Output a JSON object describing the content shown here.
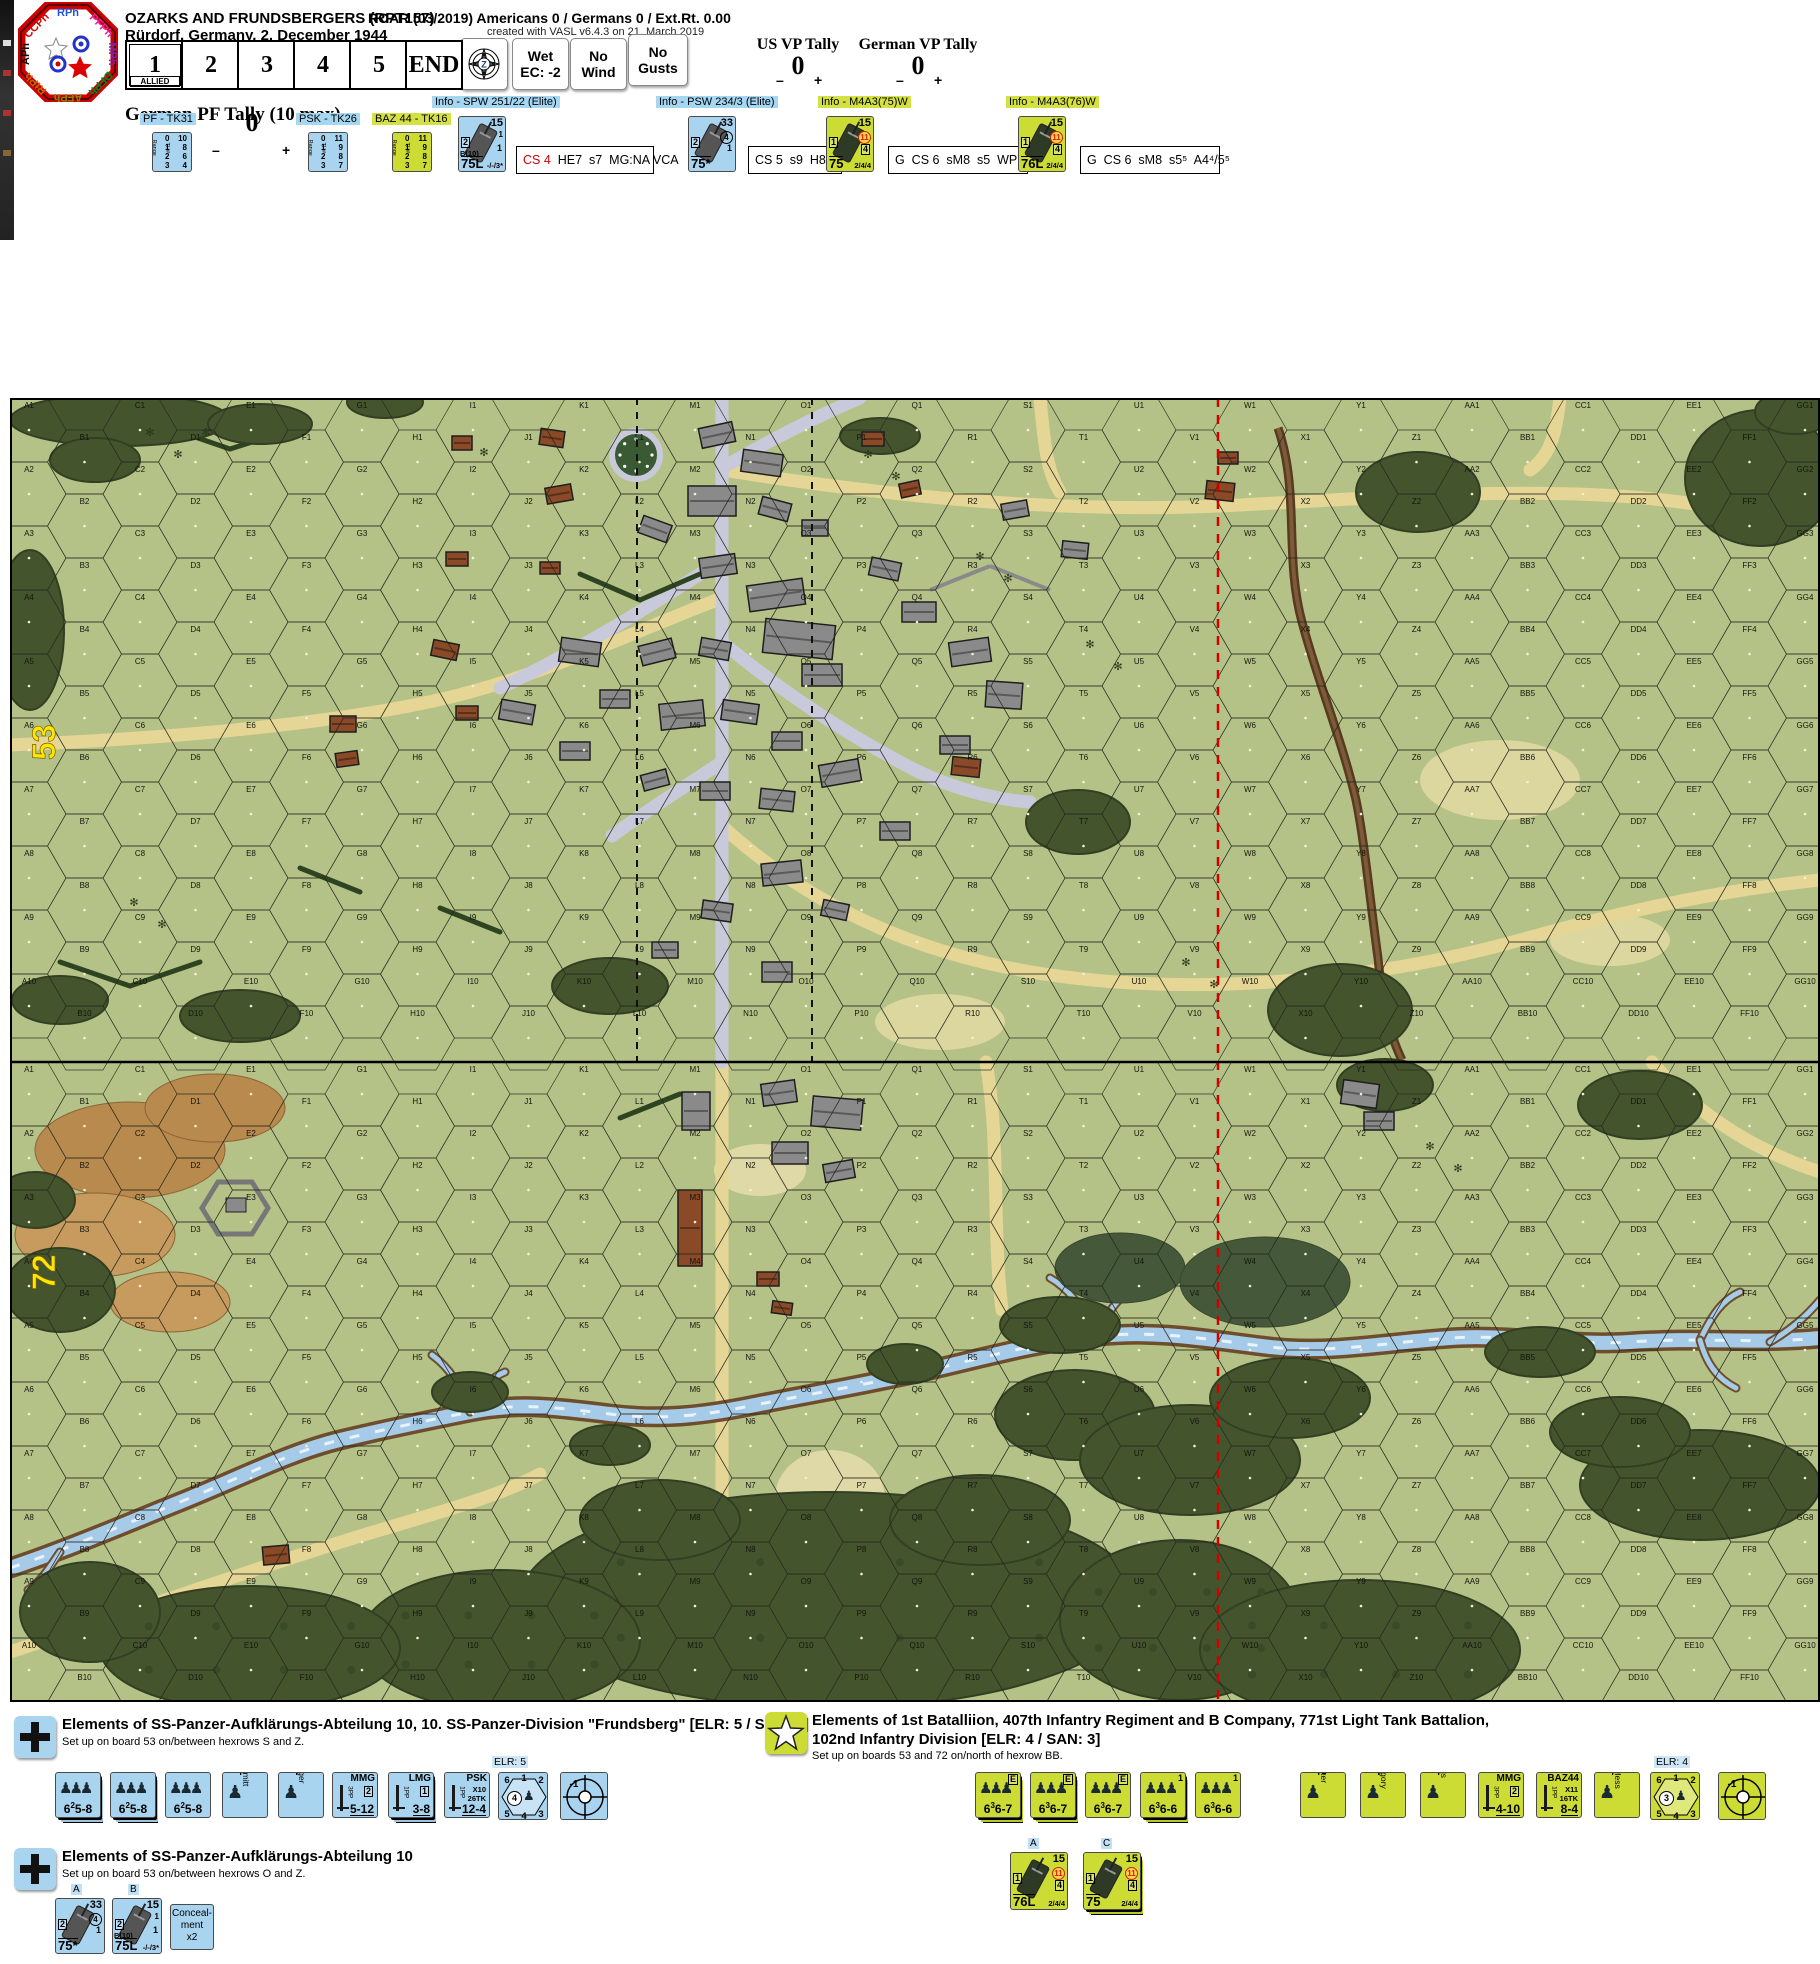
{
  "window": {
    "phase_wheel": {
      "phases": [
        {
          "label": "RPh",
          "color": "#2255dd"
        },
        {
          "label": "PFPh",
          "color": "#ee22aa"
        },
        {
          "label": "MPh",
          "color": "#7722bb"
        },
        {
          "label": "DFPh",
          "color": "#008822"
        },
        {
          "label": "AFPh",
          "color": "#888800"
        },
        {
          "label": "RtPh",
          "color": "#cc6600"
        },
        {
          "label": "APh",
          "color": "#111111"
        },
        {
          "label": "CCPh",
          "color": "#dd0000"
        }
      ]
    },
    "title": "OZARKS AND FRUNDSBERGERS (RPT157)",
    "subtitle": "Rürdorf, Germany, 2. December 1944",
    "roar": "ROAR (03/2019) Americans 0 / Germans 0 / Ext.Rt. 0.00",
    "created": "created with VASL v6.4.3 on 21. March 2019",
    "turn_track": {
      "cells": [
        "1",
        "2",
        "3",
        "4",
        "5",
        "END"
      ],
      "active_index": 0,
      "active_sub": "ALLIED"
    },
    "weather": [
      [
        "Wet",
        "EC: -2"
      ],
      [
        "No",
        "Wind"
      ],
      [
        "No",
        "Gusts"
      ]
    ],
    "us_vp": {
      "label": "US VP Tally",
      "value": "0",
      "minus": "–",
      "plus": "+"
    },
    "german_vp": {
      "label": "German VP Tally",
      "value": "0",
      "minus": "–",
      "plus": "+"
    },
    "pf_tally": {
      "label": "German PF Tally (10 max)",
      "value": "0",
      "minus": "–",
      "plus": "+"
    }
  },
  "ordnance": [
    {
      "label": "PF - TK31",
      "style": "blue",
      "x": 140,
      "cx": 152,
      "col1": "Range",
      "col2": "TH#",
      "rows": [
        [
          "0",
          "10"
        ],
        [
          "1",
          "8"
        ],
        [
          "2",
          "6"
        ],
        [
          "3",
          "4"
        ]
      ]
    },
    {
      "label": "PSK - TK26",
      "style": "blue",
      "x": 296,
      "cx": 308,
      "col1": "Range",
      "col2": "TH#",
      "rows": [
        [
          "0",
          "11"
        ],
        [
          "1",
          "9"
        ],
        [
          "2",
          "8"
        ],
        [
          "3",
          "7"
        ]
      ]
    },
    {
      "label": "BAZ 44 - TK16",
      "style": "grn",
      "x": 372,
      "cx": 392,
      "col1": "Range",
      "col2": "TH#",
      "rows": [
        [
          "0",
          "11"
        ],
        [
          "1",
          "9"
        ],
        [
          "2",
          "8"
        ],
        [
          "3",
          "7"
        ]
      ]
    }
  ],
  "vehicles": [
    {
      "label": "Info - SPW 251/22 (Elite)",
      "style": "blue",
      "lx": 432,
      "cx": 458,
      "bx": 516,
      "bw": 124,
      "tr": "15",
      "m1": "1",
      "m2": "1",
      "left": "2",
      "b10": "B(10)",
      "gun": "75L",
      "extra": "-/-/3*",
      "info": [
        [
          "CS 4",
          "red"
        ],
        [
          "  HE7  s7  MG:NA VCA",
          ""
        ]
      ]
    },
    {
      "label": "Info - PSW 234/3 (Elite)",
      "style": "blue",
      "lx": 656,
      "cx": 688,
      "bx": 748,
      "bw": 80,
      "tr": "33",
      "m1": "(4)",
      "m2": "1",
      "left": "2",
      "b10": "",
      "gun": "75*",
      "extra": "",
      "info": [
        [
          "CS 5  s9  H8",
          ""
        ]
      ]
    },
    {
      "label": "Info - M4A3(75)W",
      "style": "grn",
      "lx": 818,
      "cx": 826,
      "bx": 888,
      "bw": 126,
      "tr": "15",
      "m1": "(11)",
      "m2": "[4]",
      "left": "1",
      "b10": "",
      "gun": "75",
      "extra": "2/4/4",
      "info": [
        [
          "G  CS 6  sM8  s5  WP7",
          ""
        ]
      ]
    },
    {
      "label": "Info - M4A3(76)W",
      "style": "grn",
      "lx": 1006,
      "cx": 1018,
      "bx": 1080,
      "bw": 126,
      "tr": "15",
      "m1": "(11)",
      "m2": "[4]",
      "left": "1",
      "b10": "",
      "gun": "76L",
      "extra": "2/4/4",
      "info": [
        [
          "G  CS 6  sM8  s5⁵  A4⁴/5⁵",
          ""
        ]
      ]
    }
  ],
  "map": {
    "board53": "53",
    "board72": "72",
    "columns": [
      "A",
      "B",
      "C",
      "D",
      "E",
      "F",
      "G",
      "H",
      "I",
      "J",
      "K",
      "L",
      "M",
      "N",
      "O",
      "P",
      "Q",
      "R",
      "S",
      "T",
      "U",
      "V",
      "W",
      "X",
      "Y",
      "Z",
      "AA",
      "BB",
      "CC",
      "DD",
      "EE",
      "FF",
      "GG"
    ],
    "rows": 10
  },
  "setup": {
    "german1": {
      "title": "Elements of SS-Panzer-Aufklärungs-Abteilung 10, 10. SS-Panzer-Division \"Frundsberg\" [ELR: 5 / SAN: 4]",
      "subtitle": "Set up on board 53 on/between hexrows S and Z.",
      "elr_note": "ELR: 5",
      "counters": [
        {
          "kind": "squad",
          "x": 55,
          "style": "blue",
          "stack": true,
          "p1": "6",
          "sup": "2",
          "p2": "5-8",
          "badge": ""
        },
        {
          "kind": "squad",
          "x": 110,
          "style": "blue",
          "stack": true,
          "p1": "6",
          "sup": "2",
          "p2": "5-8",
          "badge": ""
        },
        {
          "kind": "squad",
          "x": 165,
          "style": "blue",
          "stack": false,
          "p1": "6",
          "sup": "2",
          "p2": "5-8",
          "badge": ""
        },
        {
          "kind": "leader",
          "x": 222,
          "style": "blue",
          "name": "Schmitt",
          "rating": "9-1"
        },
        {
          "kind": "leader",
          "x": 278,
          "style": "blue",
          "name": "Berger",
          "rating": "8-1"
        },
        {
          "kind": "sw",
          "x": 332,
          "style": "blue",
          "name": "MMG",
          "pp": "3PP",
          "boxn": "2",
          "l1": "",
          "l2": "",
          "range": "5-12"
        },
        {
          "kind": "sw",
          "x": 388,
          "style": "blue",
          "stack": true,
          "name": "LMG",
          "pp": "1PP",
          "boxn": "1",
          "l1": "",
          "l2": "",
          "range": "3-8"
        },
        {
          "kind": "sw",
          "x": 444,
          "style": "blue",
          "name": "PSK",
          "pp": "1PP",
          "boxn": "",
          "l1": "X10",
          "l2": "26TK",
          "range": "12-4"
        },
        {
          "kind": "hex",
          "x": 498,
          "style": "blue",
          "nums": [
            "6",
            "1",
            "2",
            "3",
            "4",
            "5"
          ],
          "circ": "4"
        },
        {
          "kind": "sniper",
          "x": 560,
          "style": "blue",
          "val": "-1"
        }
      ]
    },
    "german2": {
      "title": "Elements of SS-Panzer-Aufklärungs-Abteilung 10",
      "subtitle": "Set up on board 53 on/between hexrows O and Z.",
      "vehicles": [
        {
          "letter": "A",
          "x": 55,
          "style": "blue",
          "tr": "33",
          "m1": "(4)",
          "m2": "1",
          "left": "2",
          "b10": "",
          "gun": "75*",
          "extra": "",
          "stack": false
        },
        {
          "letter": "B",
          "x": 112,
          "style": "blue",
          "tr": "15",
          "m1": "1",
          "m2": "1",
          "left": "2",
          "b10": "B(10)",
          "gun": "75L",
          "extra": "-/-/3*",
          "stack": false
        }
      ],
      "conceal": {
        "x": 170,
        "lines": [
          "Conceal-",
          "ment",
          "x2"
        ]
      }
    },
    "us": {
      "title1": "Elements of 1st Batalliion, 407th Infantry Regiment and B Company, 771st Light Tank Battalion,",
      "title2": "102nd Infantry Division [ELR: 4 / SAN: 3]",
      "subtitle": "Set up on boards 53 and 72 on/north of hexrow BB.",
      "elr_note": "ELR: 4",
      "counters": [
        {
          "kind": "squad",
          "x": 975,
          "style": "grn",
          "stack": true,
          "p1": "6",
          "sup": "3",
          "p2": "6-7",
          "badge": "E"
        },
        {
          "kind": "squad",
          "x": 1030,
          "style": "grn",
          "stack": true,
          "p1": "6",
          "sup": "3",
          "p2": "6-7",
          "badge": "E"
        },
        {
          "kind": "squad",
          "x": 1085,
          "style": "grn",
          "stack": false,
          "p1": "6",
          "sup": "3",
          "p2": "6-7",
          "badge": "E"
        },
        {
          "kind": "squad",
          "x": 1140,
          "style": "grn",
          "stack": true,
          "p1": "6",
          "sup": "3",
          "p2": "6-6",
          "badge": "1"
        },
        {
          "kind": "squad",
          "x": 1195,
          "style": "grn",
          "stack": false,
          "p1": "6",
          "sup": "3",
          "p2": "6-6",
          "badge": "1"
        },
        {
          "kind": "leader",
          "x": 1300,
          "style": "grn",
          "name": "Parker",
          "rating": "9-2"
        },
        {
          "kind": "leader",
          "x": 1360,
          "style": "grn",
          "name": "Gregory",
          "rating": "9-1"
        },
        {
          "kind": "leader",
          "x": 1420,
          "style": "grn",
          "name": "Willis",
          "rating": "8-1"
        },
        {
          "kind": "sw",
          "x": 1478,
          "style": "grn",
          "name": "MMG",
          "pp": "3PP",
          "boxn": "2",
          "l1": "",
          "l2": "",
          "range": "4-10"
        },
        {
          "kind": "sw",
          "x": 1536,
          "style": "grn",
          "name": "BAZ44",
          "pp": "1PP",
          "boxn": "",
          "l1": "X11",
          "l2": "16TK",
          "range": "8-4"
        },
        {
          "kind": "leader",
          "x": 1594,
          "style": "grn",
          "name": "Lawless",
          "rating": "9-1"
        },
        {
          "kind": "hex",
          "x": 1650,
          "style": "grn",
          "nums": [
            "6",
            "1",
            "2",
            "3",
            "4",
            "5"
          ],
          "circ": "3"
        },
        {
          "kind": "sniper",
          "x": 1718,
          "style": "grn",
          "val": "-1"
        }
      ],
      "tanks": [
        {
          "letter": "A",
          "x": 1010,
          "style": "grn",
          "tr": "15",
          "m1": "(11)",
          "m2": "[4]",
          "left": "1",
          "gun": "76L",
          "extra": "2/4/4",
          "stack": false
        },
        {
          "letter": "C",
          "x": 1083,
          "style": "grn",
          "tr": "15",
          "m1": "(11)",
          "m2": "[4]",
          "left": "1",
          "gun": "75",
          "extra": "2/4/4",
          "stack": true
        }
      ]
    }
  }
}
